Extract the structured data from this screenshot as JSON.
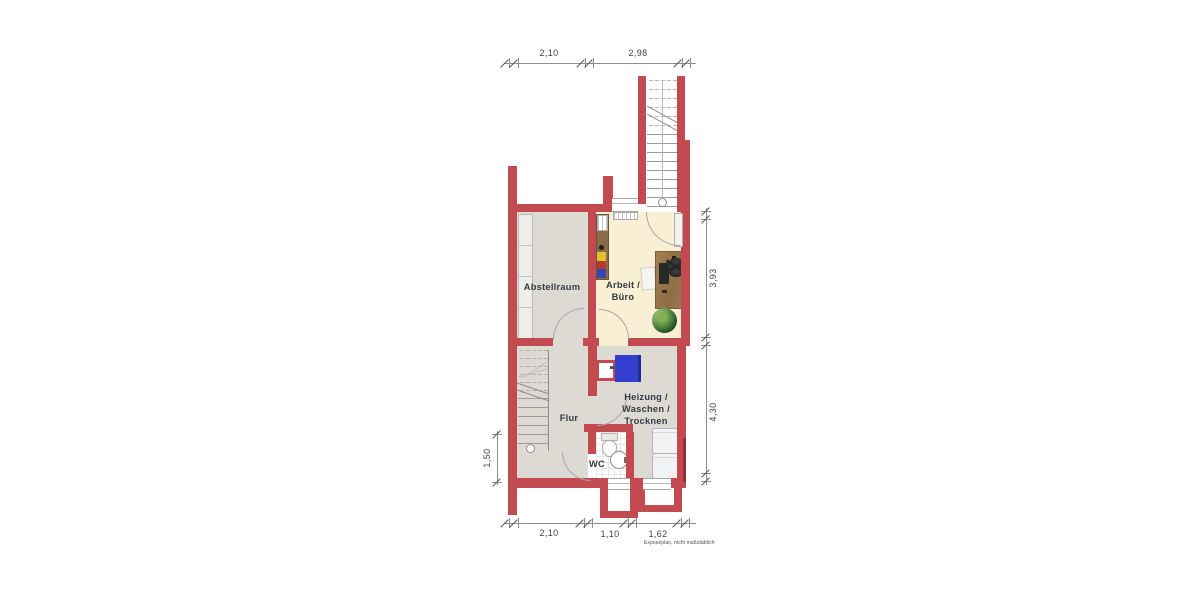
{
  "plan": {
    "rooms": {
      "abstellraum": "Abstellraum",
      "arbeit_buero": "Arbeit /\nBüro",
      "flur": "Flur",
      "heizung_waschen_trocknen": "Heizung /\nWaschen /\nTrocknen",
      "wc": "WC"
    },
    "dimensions": {
      "top": [
        "2,10",
        "2,98"
      ],
      "bottom": [
        "2,10",
        "1,10",
        "1,62"
      ],
      "right": [
        "3,93",
        "4,30"
      ],
      "left": [
        "1,50"
      ]
    },
    "disclaimer": "Exposéplan, nicht maßstäblich",
    "colors": {
      "wall_red": "#c24a50",
      "floor_gray": "#dcdad3",
      "floor_cream": "#f8efd4",
      "boiler_blue": "#3340cf",
      "plant_green": "#4e8a3f"
    }
  }
}
